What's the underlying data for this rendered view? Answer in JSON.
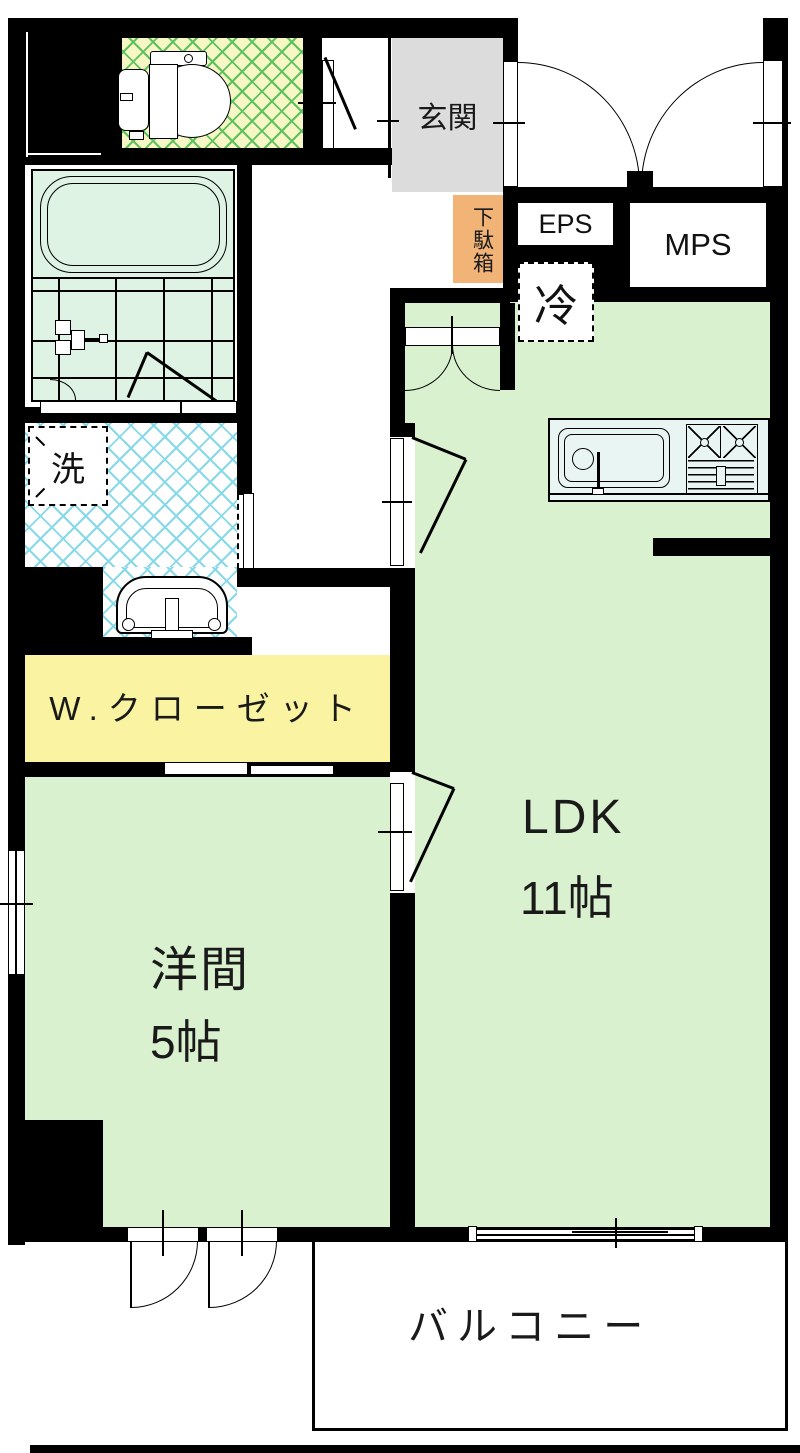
{
  "floorplan": {
    "type": "apartment-floor-plan",
    "wall_color": "#000000",
    "labels": {
      "entrance": "玄関",
      "shoe_cabinet": "下駄箱",
      "eps": "EPS",
      "mps": "MPS",
      "refrigerator": "冷",
      "laundry": "洗",
      "walk_in_closet": "W.クローゼット",
      "ldk_name": "LDK",
      "ldk_size": "11帖",
      "western_room_name": "洋間",
      "western_room_size": "5帖",
      "balcony": "バルコニー"
    },
    "colors": {
      "room_green": "#d9f1cf",
      "bath_green": "#def3e4",
      "closet_yellow": "#f9f3a2",
      "entrance_gray": "#dcdcdc",
      "shoe_cabinet_orange": "#f2b376",
      "toilet_floor": "#f7f7c6",
      "toilet_hatch_line": "#5cc25c",
      "washroom_hatch_line": "#86d9e8",
      "kitchen_counter": "#e9f5f3"
    },
    "fixtures": [
      "toilet",
      "bathtub",
      "shower",
      "vanity-sink",
      "washing-machine-space",
      "kitchen-sink",
      "stove",
      "refrigerator-space"
    ]
  }
}
